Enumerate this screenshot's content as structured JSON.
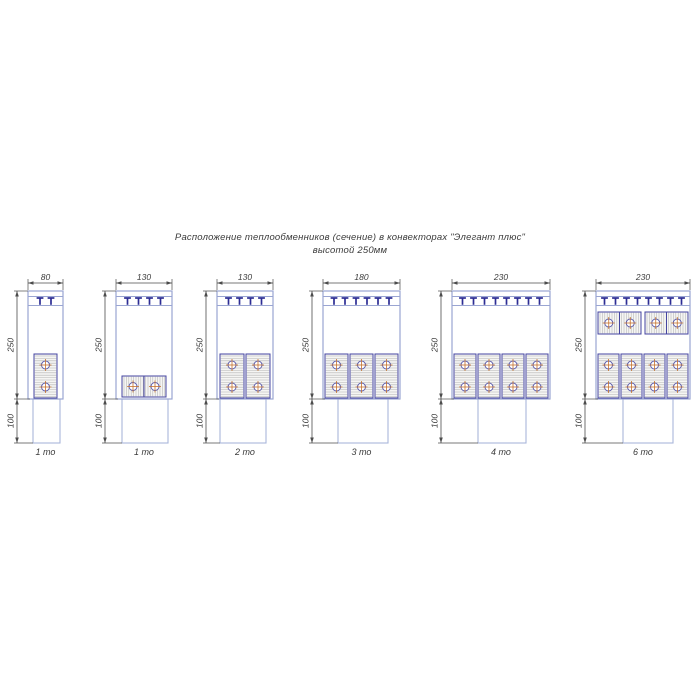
{
  "title": {
    "line1": "Расположение теплообменников (сечение) в конвекторах \"Элегант плюс\"",
    "line2": "высотой 250мм"
  },
  "colors": {
    "body_outline": "#9aa5d2",
    "duct_outline": "#a9b6da",
    "bracket": "#2d2d94",
    "dim_line": "#4c4c4c",
    "dim_text": "#3c3c3c",
    "exchanger_border": "#4444a0",
    "hatch": "#b3b3b3",
    "exchanger_fill": "#f5f5f3",
    "tube_ring": "#5c5cac",
    "tube_cross": "#c6722c",
    "caption_text": "#3a3a3a"
  },
  "layout": {
    "dim_line_y": 283,
    "dim_text_y": 280,
    "body_top": 291,
    "grille_line1": 296.5,
    "grille_line2": 305.5,
    "body_bottom": 399,
    "duct_bottom": 443,
    "caption_y": 455,
    "left_dim_offset": 11,
    "bracket_spacing": 11
  },
  "diagrams": [
    {
      "caption": "1 то",
      "width_label": "80",
      "height_label": "250",
      "duct_label": "100",
      "body_x": 28,
      "body_w": 35,
      "duct_x": 33,
      "duct_w": 27,
      "brackets": 2,
      "exchangers": [
        {
          "orient": "v",
          "x": 34,
          "y": 354,
          "cells": 1,
          "cell_w": 23,
          "cell_h": 44,
          "gap": 2
        }
      ]
    },
    {
      "caption": "1 то",
      "width_label": "130",
      "height_label": "250",
      "duct_label": "100",
      "body_x": 116,
      "body_w": 56,
      "duct_x": 122,
      "duct_w": 46,
      "brackets": 4,
      "exchangers": [
        {
          "orient": "h",
          "x": 122,
          "y": 376,
          "cells": 1,
          "cell_w": 44,
          "cell_h": 21,
          "gap": 3
        }
      ]
    },
    {
      "caption": "2 то",
      "width_label": "130",
      "height_label": "250",
      "duct_label": "100",
      "body_x": 217,
      "body_w": 56,
      "duct_x": 220,
      "duct_w": 46,
      "brackets": 4,
      "exchangers": [
        {
          "orient": "v",
          "x": 220,
          "y": 354,
          "cells": 2,
          "cell_w": 24,
          "cell_h": 44,
          "gap": 2
        }
      ]
    },
    {
      "caption": "3 то",
      "width_label": "180",
      "height_label": "250",
      "duct_label": "100",
      "body_x": 323,
      "body_w": 77,
      "duct_x": 338,
      "duct_w": 50,
      "brackets": 6,
      "exchangers": [
        {
          "orient": "v",
          "x": 325,
          "y": 354,
          "cells": 3,
          "cell_w": 23,
          "cell_h": 44,
          "gap": 2
        }
      ]
    },
    {
      "caption": "4 то",
      "width_label": "230",
      "height_label": "250",
      "duct_label": "100",
      "body_x": 452,
      "body_w": 98,
      "duct_x": 478,
      "duct_w": 48,
      "brackets": 8,
      "exchangers": [
        {
          "orient": "v",
          "x": 454,
          "y": 354,
          "cells": 4,
          "cell_w": 22,
          "cell_h": 44,
          "gap": 2
        }
      ]
    },
    {
      "caption": "6 то",
      "width_label": "230",
      "height_label": "250",
      "duct_label": "100",
      "body_x": 596,
      "body_w": 94,
      "duct_x": 623,
      "duct_w": 50,
      "brackets": 8,
      "exchangers": [
        {
          "orient": "h",
          "x": 598,
          "y": 312,
          "cells": 2,
          "cell_w": 43,
          "cell_h": 22,
          "gap": 4
        },
        {
          "orient": "v",
          "x": 598,
          "y": 354,
          "cells": 4,
          "cell_w": 21,
          "cell_h": 44,
          "gap": 2
        }
      ]
    }
  ]
}
